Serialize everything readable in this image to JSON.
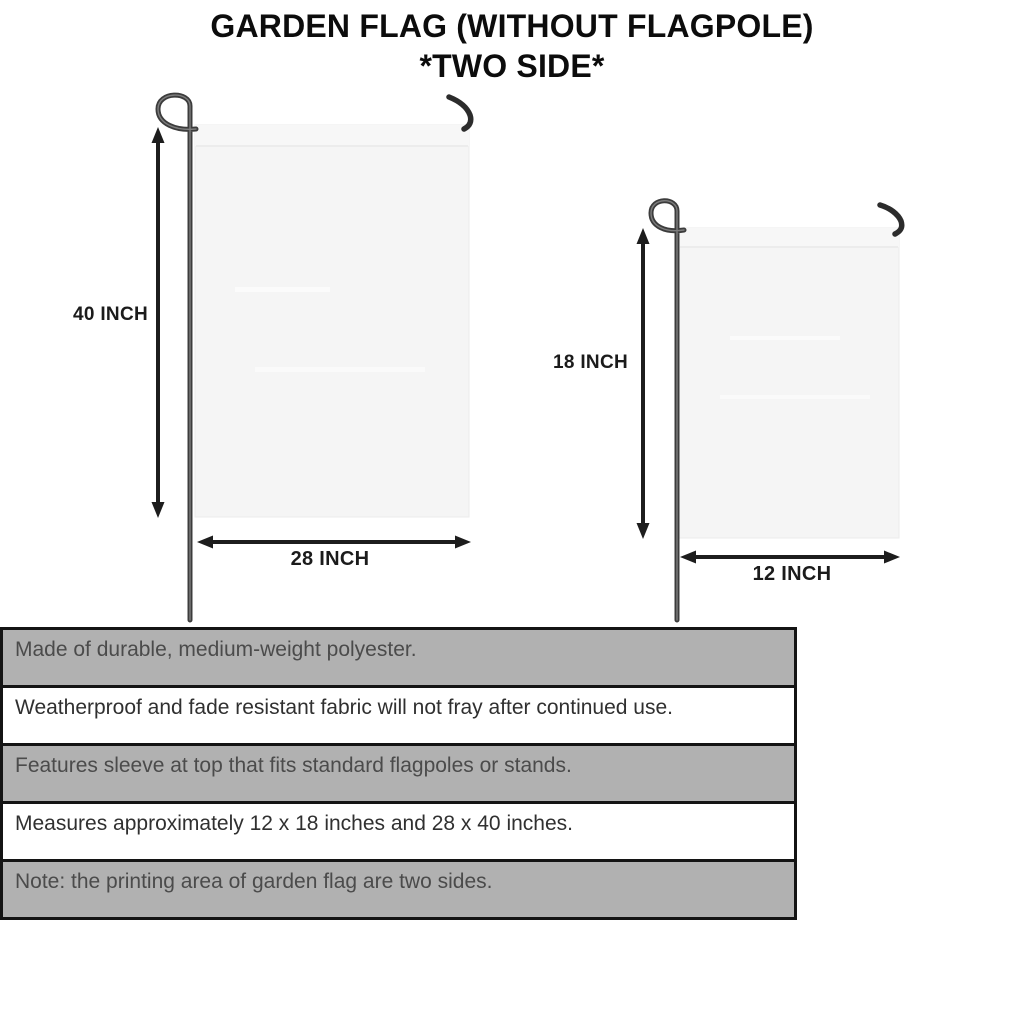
{
  "title": {
    "line1": "GARDEN FLAG (WITHOUT FLAGPOLE)",
    "line2": "*TWO SIDE*"
  },
  "diagram": {
    "large_flag": {
      "height_label": "40 INCH",
      "width_label": "28 INCH"
    },
    "small_flag": {
      "height_label": "18 INCH",
      "width_label": "12 INCH"
    }
  },
  "features": {
    "rows": [
      {
        "text": "Made of durable, medium-weight polyester."
      },
      {
        "text": "Weatherproof and fade resistant fabric will not fray after continued use."
      },
      {
        "text": "Features sleeve at top that fits standard flagpoles or stands."
      },
      {
        "text": "Measures approximately 12 x 18 inches and 28 x 40 inches."
      },
      {
        "text": "Note: the printing area of garden flag are two sides."
      }
    ]
  },
  "colors": {
    "row_shade": "#b1b1b1",
    "flag_fill": "#f5f5f5",
    "pole": "#3f3f3f",
    "arrow": "#1d1d1d",
    "table_border": "#141414"
  }
}
